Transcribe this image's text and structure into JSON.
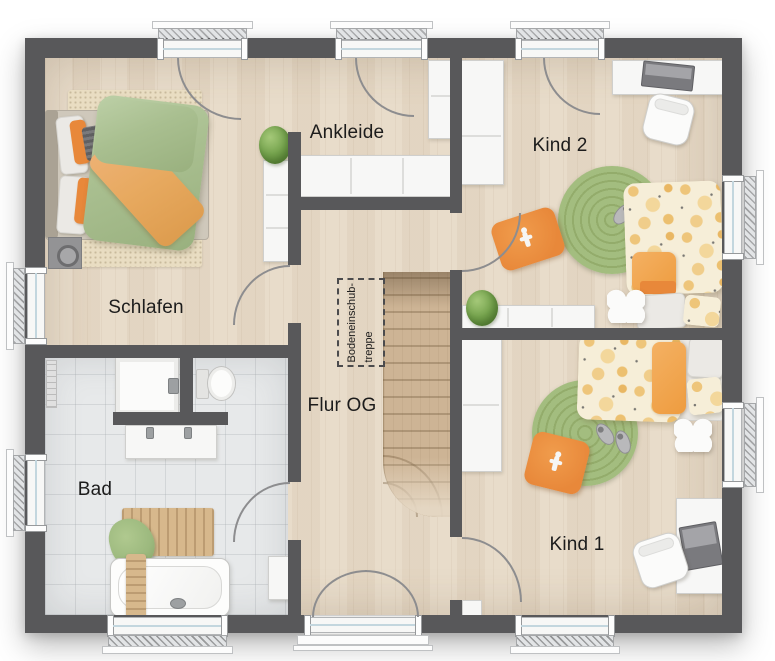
{
  "rooms": [
    {
      "id": "schlafen",
      "label": "Schlafen"
    },
    {
      "id": "ankleide",
      "label": "Ankleide"
    },
    {
      "id": "kind2",
      "label": "Kind 2"
    },
    {
      "id": "bad",
      "label": "Bad"
    },
    {
      "id": "flur-og",
      "label": "Flur OG"
    },
    {
      "id": "kind1",
      "label": "Kind 1"
    }
  ],
  "attic_ladder": {
    "line1": "Bodeneinschub-",
    "line2": "treppe"
  },
  "colors": {
    "wall": "#58585a",
    "floor_wood": "#e7dac7",
    "floor_tile": "#e7e9ea",
    "stair_wood": "#cdb495",
    "furniture_white": "#f7f7f6",
    "accent_orange": "#e8883a",
    "throw_orange": "#e7a95f",
    "rug_green": "#a3bd7f",
    "duvet_green": "#a9bf90",
    "plant_green": "#76a44e",
    "duvet_cream": "#f6eed8",
    "dot_orange": "#eec57a",
    "label_ink": "#1c1c1c",
    "door_arc": "#8d8d8f",
    "window_glass": "#c3d6de",
    "mat_wood": "#d7b88c",
    "towel_green": "#9cb97e"
  }
}
